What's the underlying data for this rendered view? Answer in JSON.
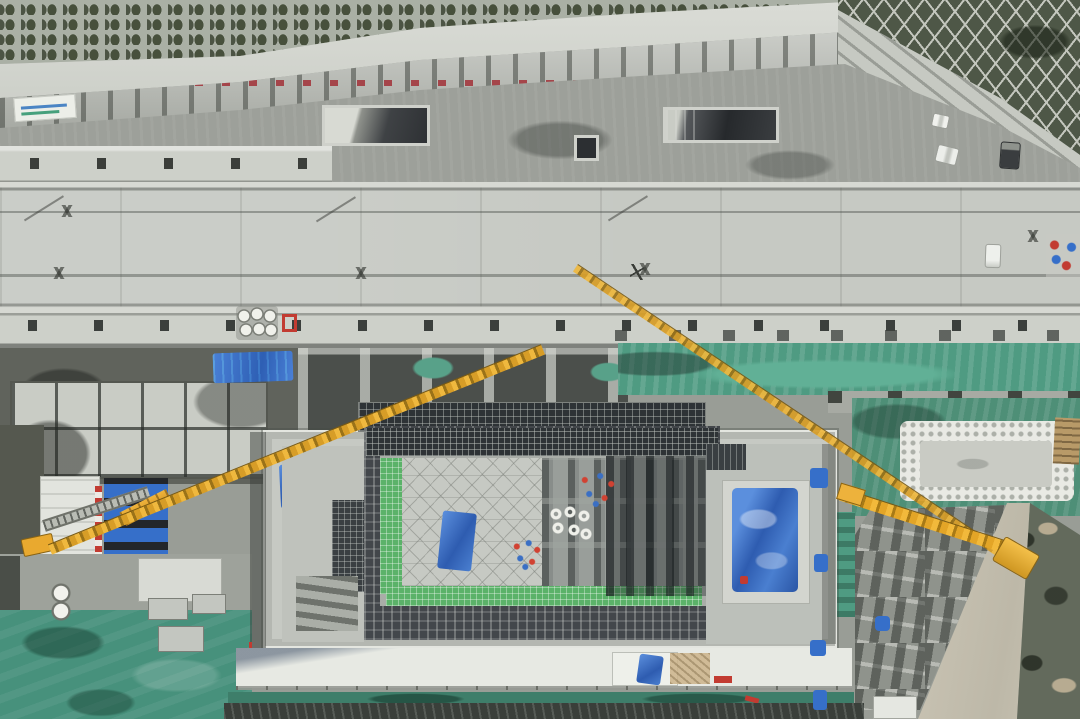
{
  "scene": {
    "title": "Aerial drone photo: top-down view of a metro station construction site beside a terraced hillside road",
    "setting": "overhead construction-site aerial photograph, no visible legible text",
    "regions": [
      {
        "name": "terraced-hillside",
        "label": "terraced slope with arched planting cells"
      },
      {
        "name": "diamond-slope",
        "label": "diamond-grid slope protection with vegetation"
      },
      {
        "name": "retaining-wall",
        "label": "ribbed retaining wall with small red paint markings"
      },
      {
        "name": "haul-road",
        "label": "gravel access road with parked vehicles"
      },
      {
        "name": "station-roof-deck",
        "label": "cast concrete roof deck with expansion joints and access hatches"
      },
      {
        "name": "station-box",
        "label": "station box under construction with open excavation, rebar mats and green safety mesh"
      },
      {
        "name": "secondary-pit",
        "label": "sandbag-ringed secondary excavation pit"
      },
      {
        "name": "laydown-yard",
        "label": "material laydown yard with stacked precast blocks"
      },
      {
        "name": "dust-netting",
        "label": "green dust-control netting over spoil"
      },
      {
        "name": "tower-crane-jibs",
        "label": "yellow crane jibs crossing the site",
        "count": 3
      }
    ],
    "vehicle_count": 4,
    "worker_clusters": 2
  },
  "colors": {
    "gravel": "#9da09a",
    "deck": "#c6c9c3",
    "ledge": "#cdd0c9",
    "concrete": "#dadcd6",
    "wallLight": "#c0c3bc",
    "hillGrey": "#aab0a5",
    "vegDark": "#47503c",
    "diamondDark": "#4e5747",
    "gridLine": "#c3c6bd",
    "trenchDark": "#4b4f4b",
    "scaffold": "#43474b",
    "rebar": "#2e3336",
    "netGreen": "#4f9b82",
    "meshGreen": "#5bb269",
    "fieldGreen": "#47917c",
    "groundGrey": "#999d96",
    "yardGrey": "#8f938c",
    "dirtTan": "#b89a68",
    "scrubDark": "#636a5c",
    "craneYellow": "#e9a92f",
    "tarpBlue": "#366fc9",
    "alertRed": "#c23b31",
    "truckGrey": "#3a3d3f",
    "sandbagWhite": "#e9eae4",
    "formwork": "#c6c9c3",
    "cellCover": "#c9ccc5"
  }
}
